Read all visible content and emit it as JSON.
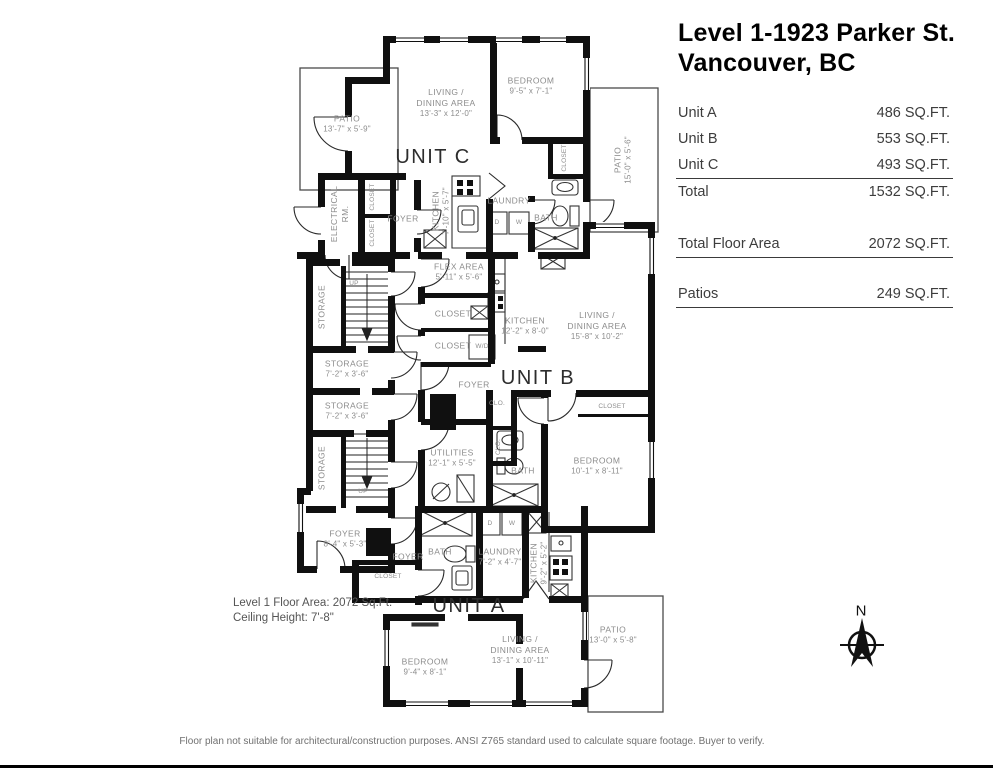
{
  "title": {
    "line1": "Level 1-1923 Parker St.",
    "line2": "Vancouver, BC"
  },
  "table": {
    "unit_a": {
      "label": "Unit A",
      "value": "486 SQ.FT."
    },
    "unit_b": {
      "label": "Unit B",
      "value": "553 SQ.FT."
    },
    "unit_c": {
      "label": "Unit C",
      "value": "493 SQ.FT."
    },
    "total": {
      "label": "Total",
      "value": "1532 SQ.FT."
    },
    "total_floor_area": {
      "label": "Total Floor Area",
      "value": "2072 SQ.FT."
    },
    "patios": {
      "label": "Patios",
      "value": "249 SQ.FT."
    }
  },
  "units": {
    "a": "UNIT A",
    "b": "UNIT B",
    "c": "UNIT C"
  },
  "labels": {
    "patio": "PATIO",
    "living1": "LIVING /",
    "living2": "DINING AREA",
    "bedroom": "BEDROOM",
    "kitchen": "KITCHEN",
    "laundry": "LAUNDRY",
    "bath": "BATH",
    "foyer": "FOYER",
    "closet": "CLOSET",
    "clo": "CLO.",
    "storage": "STORAGE",
    "up": "UP",
    "flex": "FLEX AREA",
    "utilities": "UTILITIES",
    "electrical1": "ELECTRICAL",
    "electrical2": "RM.",
    "d": "D",
    "w": "W",
    "wd": "W/D"
  },
  "dims": {
    "patio_c": "13'-7\" x 5'-9\"",
    "living_c": "13'-3\" x 12'-0\"",
    "bedroom_c": "9'-5\" x 7'-1\"",
    "patio_right": "15'-0\" x 5'-6\"",
    "kitchen_c": "7'-10\" x 5'-7\"",
    "flex": "5'-11\" x 5'-6\"",
    "storage": "7'-2\" x 3'-6\"",
    "kitchen_b": "12'-2\" x 8'-0\"",
    "living_b": "15'-8\" x 10'-2\"",
    "utilities": "12'-1\" x 5'-5\"",
    "bedroom_b": "10'-1\" x 8'-11\"",
    "foyer_main": "8'-4\" x 5'-3\"",
    "laundry_a": "7'-2\" x 4'-7\"",
    "kitchen_a": "9'-2\" x 5'-2\"",
    "bedroom_a": "9'-4\" x 8'-1\"",
    "living_a": "13'-1\" x 10'-11\"",
    "patio_a": "13'-0\" x 5'-8\""
  },
  "notes": {
    "floor_area": "Level 1 Floor Area: 2072 Sq.Ft.",
    "ceiling": "Ceiling Height: 7'-8\""
  },
  "compass": {
    "n": "N"
  },
  "disclaimer": "Floor plan not suitable for architectural/construction purposes. ANSI Z765 standard used to calculate square footage. Buyer to verify."
}
